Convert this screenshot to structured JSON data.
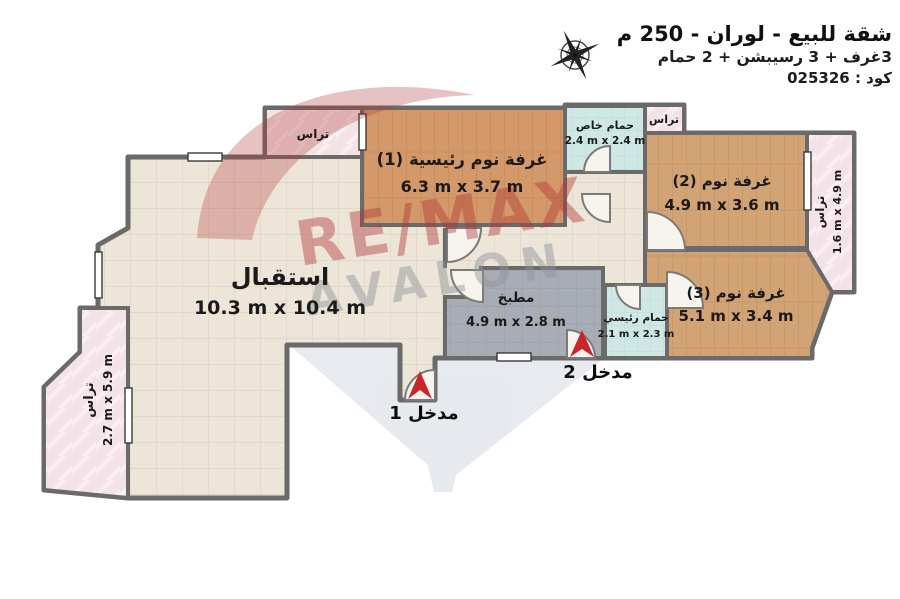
{
  "header": {
    "title": "شقة للبيع - لوران - 250 م",
    "subtitle": "3غرف + 3 رسيبشن + 2 حمام",
    "code": "كود : 025326"
  },
  "watermark": {
    "line1": "RE/MAX",
    "line2": "AVALON"
  },
  "rooms": {
    "reception": {
      "name": "استقبال",
      "dims": "10.3 m x 10.4 m"
    },
    "bedroom1": {
      "name": "غرفة نوم رئيسية (1)",
      "dims": "6.3 m x 3.7 m"
    },
    "bedroom2": {
      "name": "غرفة نوم (2)",
      "dims": "4.9 m x 3.6 m"
    },
    "bedroom3": {
      "name": "غرفة نوم (3)",
      "dims": "5.1 m x 3.4 m"
    },
    "kitchen": {
      "name": "مطبخ",
      "dims": "4.9 m x 2.8 m"
    },
    "bath_private": {
      "name": "حمام خاص",
      "dims": "2.4 m x 2.4 m"
    },
    "bath_main": {
      "name": "حمام رئيسي",
      "dims": "2.1 m x 2.3 m"
    },
    "terrace_left": {
      "name": "تراس",
      "dims": "2.7 m x 5.9 m"
    },
    "terrace_right": {
      "name": "تراس",
      "dims": "1.6 m x 4.9 m"
    },
    "terrace_top": {
      "name": "تراس"
    },
    "terrace_top_right": {
      "name": "تراس"
    }
  },
  "entrances": {
    "entrance1": "مدخل 1",
    "entrance2": "مدخل 2"
  },
  "colors": {
    "wall": "#6a6a6a",
    "floor_tile": "#ece5d8",
    "bedroom_wood": "#d2a374",
    "master_wood": "#d4996a",
    "kitchen_gray": "#a8acb4",
    "bathroom_teal": "#cfe8e5",
    "terrace_pink": "#f3e2e6",
    "entrance_arrow_red": "#c9252b",
    "watermark_red": "#b03434",
    "watermark_gray": "#8d939c"
  }
}
